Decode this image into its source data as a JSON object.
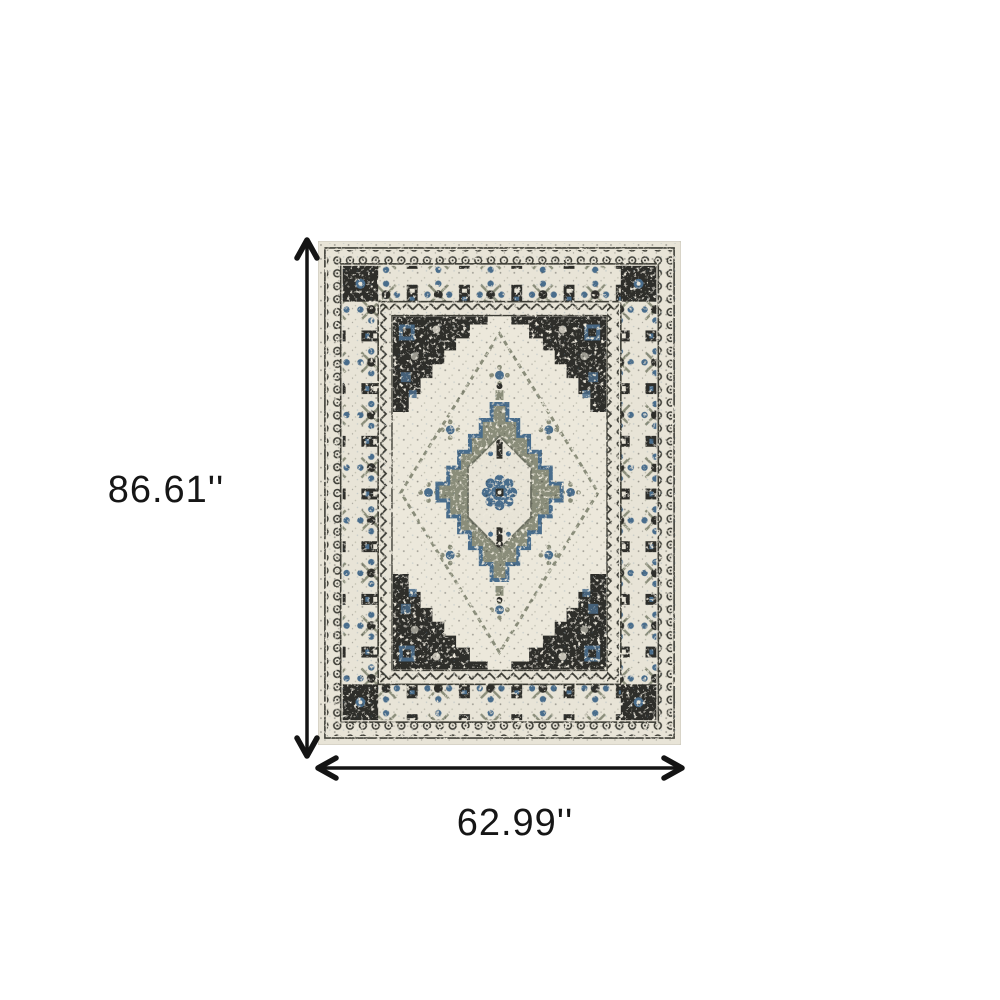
{
  "diagram": {
    "type": "product-dimensions",
    "height_label": "86.61''",
    "width_label": "62.99''"
  },
  "rug": {
    "description": "distressed oriental medallion area rug",
    "palette": {
      "ivory": "#e8e4d7",
      "field": "#ece8db",
      "charcoal": "#2e2e2a",
      "blue": "#4a6d8c",
      "sage": "#8a8d7a",
      "outline": "#3c3c36",
      "arrow": "#141414"
    }
  }
}
